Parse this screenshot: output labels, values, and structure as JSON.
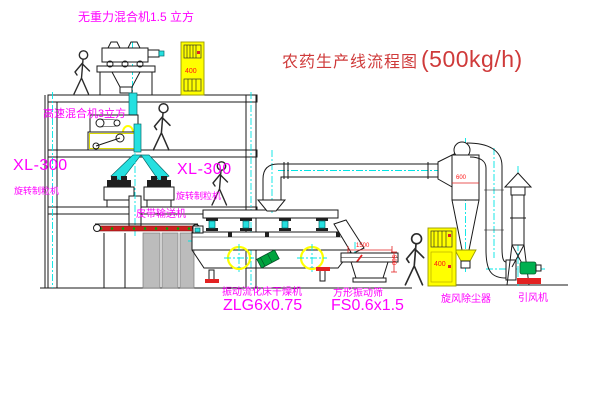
{
  "title": {
    "text": "农药生产线流程图",
    "capacity": "(500kg/h)"
  },
  "labels": {
    "top_mixer": "无重力混合机1.5 立方",
    "floor2_mixer": "高速混合机3立方",
    "granulator_left_model": "XL-300",
    "granulator_left_name": "旋转制粒机",
    "granulator_right_model": "XL-300",
    "granulator_right_name": "旋转制粒机",
    "belt_conveyor": "皮带输送机",
    "dryer_name": "振动流化床干燥机",
    "dryer_model": "ZLG6x0.75",
    "screen_name": "方形振动筛",
    "screen_model": "FS0.6x1.5",
    "cyclone": "旋风除尘器",
    "fan": "引风机"
  },
  "dimensions": {
    "top_cabinet": "400",
    "right_cabinet": "400",
    "cyclone_diameter": "600",
    "screen_length": "1500",
    "screen_height": "500"
  },
  "colors": {
    "label_magenta": "#ff00ff",
    "title_red": "#cf3a3a",
    "dimension_red": "#ff1414",
    "centerline_cyan": "#00e5e5",
    "cabinet_yellow": "#ffff00",
    "belt_red": "#cc2222",
    "motor_green": "#00a33e",
    "line_black": "#1a1a1a"
  }
}
